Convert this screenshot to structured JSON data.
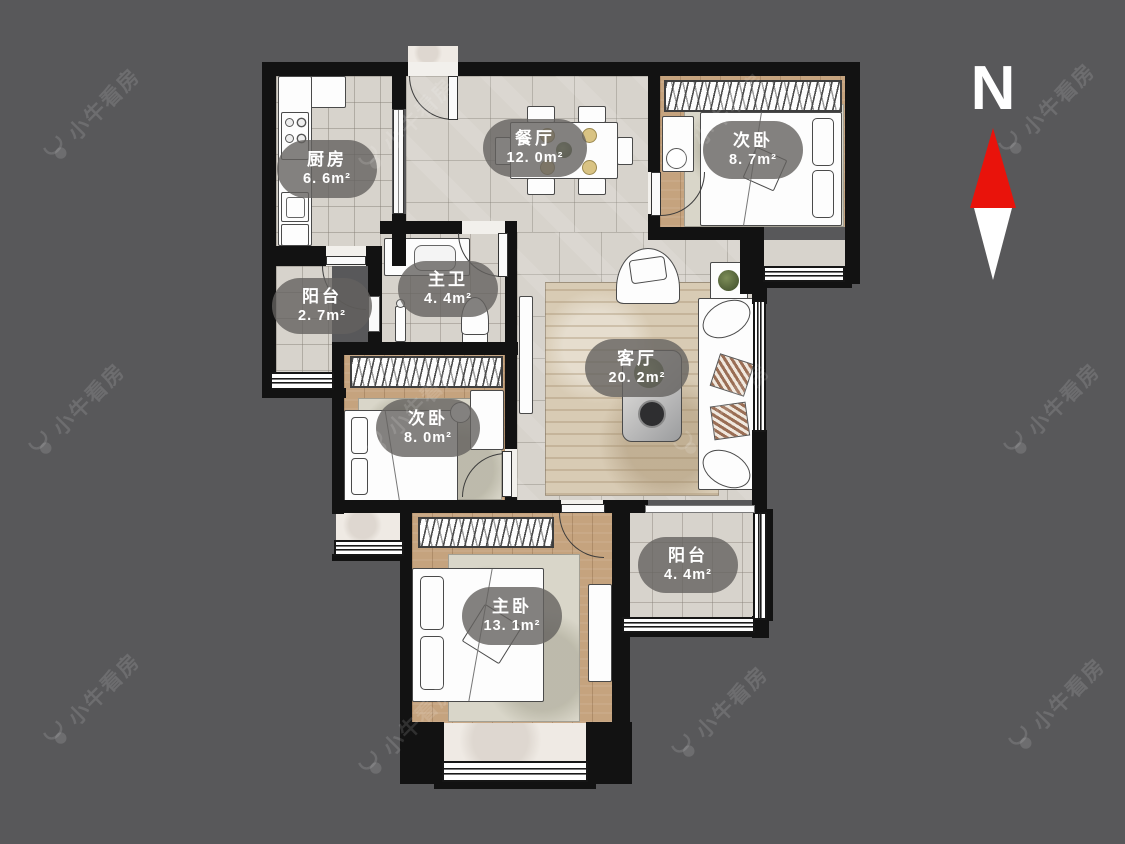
{
  "compass": {
    "north_label": "N"
  },
  "watermark": {
    "text": "小牛看房"
  },
  "colors": {
    "background": "#58585a",
    "wall": "#121212",
    "floor_tile": "#d7d3cc",
    "wood_floor": "#c5a37e",
    "label_pill": "rgba(100,98,95,0.8)",
    "compass_red": "#e9130b"
  },
  "rooms": [
    {
      "id": "kitchen",
      "name": "厨房",
      "area": "6. 6m²"
    },
    {
      "id": "dining",
      "name": "餐厅",
      "area": "12. 0m²"
    },
    {
      "id": "bedroom-top",
      "name": "次卧",
      "area": "8. 7m²"
    },
    {
      "id": "balcony-left",
      "name": "阳台",
      "area": "2. 7m²"
    },
    {
      "id": "master-bath",
      "name": "主卫",
      "area": "4. 4m²"
    },
    {
      "id": "living",
      "name": "客厅",
      "area": "20. 2m²"
    },
    {
      "id": "bedroom-mid",
      "name": "次卧",
      "area": "8. 0m²"
    },
    {
      "id": "balcony-bottom",
      "name": "阳台",
      "area": "4. 4m²"
    },
    {
      "id": "master-bedroom",
      "name": "主卧",
      "area": "13. 1m²"
    }
  ]
}
